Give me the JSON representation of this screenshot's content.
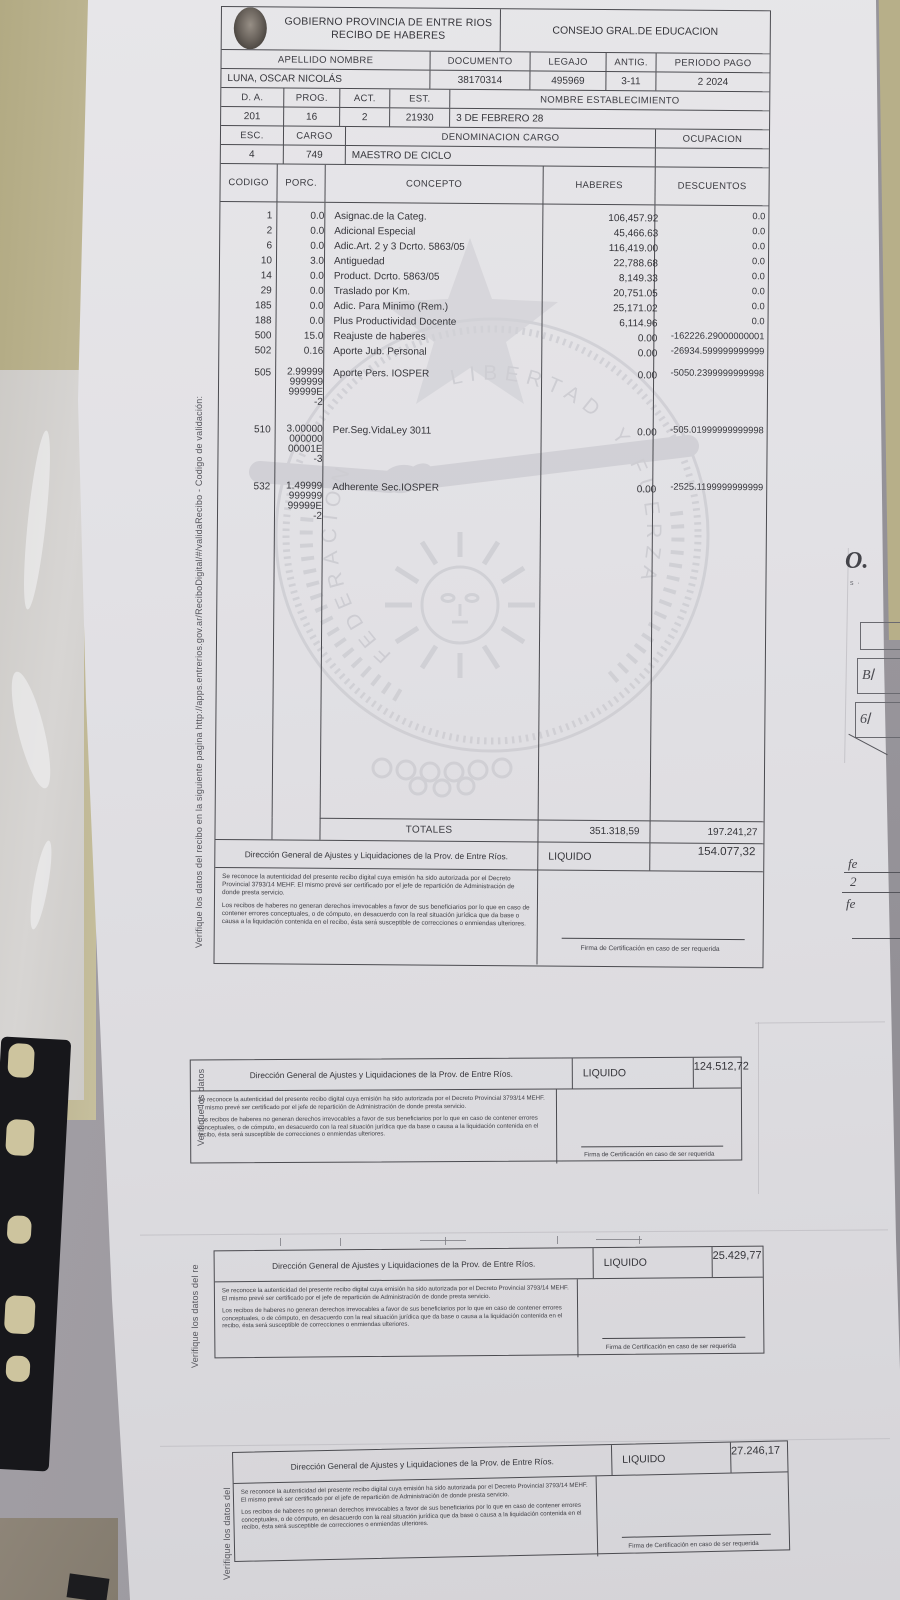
{
  "header": {
    "org_line1": "GOBIERNO PROVINCIA DE ENTRE RIOS",
    "org_line2": "RECIBO DE HABERES",
    "council": "CONSEJO GRAL.DE EDUCACION",
    "logo_name": "provincial-seal"
  },
  "employee": {
    "labels": {
      "name": "APELLIDO NOMBRE",
      "document": "DOCUMENTO",
      "file": "LEGAJO",
      "seniority": "ANTIG.",
      "pay_period": "PERIODO PAGO"
    },
    "values": {
      "name": "LUNA, OSCAR NICOLÁS",
      "document": "38170314",
      "file": "495969",
      "seniority": "3-11",
      "pay_period": "2 2024"
    }
  },
  "assignment": {
    "labels1": {
      "da": "D. A.",
      "prog": "PROG.",
      "act": "ACT.",
      "est": "EST.",
      "establishment": "NOMBRE ESTABLECIMIENTO"
    },
    "values1": {
      "da": "201",
      "prog": "16",
      "act": "2",
      "est": "21930",
      "establishment": "3 DE FEBRERO 28"
    },
    "labels2": {
      "esc": "ESC.",
      "cargo": "CARGO",
      "denominacion": "DENOMINACION CARGO",
      "ocupacion": "OCUPACION"
    },
    "values2": {
      "esc": "4",
      "cargo": "749",
      "denominacion": "MAESTRO DE CICLO",
      "ocupacion": ""
    }
  },
  "table": {
    "headers": {
      "code": "CODIGO",
      "porc": "PORC.",
      "concept": "CONCEPTO",
      "haberes": "HABERES",
      "descuentos": "DESCUENTOS"
    },
    "rows": [
      {
        "code": "1",
        "porc": "0.0",
        "concept": "Asignac.de la Categ.",
        "haberes": "106,457.92",
        "descuentos": "0.0"
      },
      {
        "code": "2",
        "porc": "0.0",
        "concept": "Adicional Especial",
        "haberes": "45,466.63",
        "descuentos": "0.0"
      },
      {
        "code": "6",
        "porc": "0.0",
        "concept": "Adic.Art. 2 y 3 Dcrto. 5863/05",
        "haberes": "116,419.00",
        "descuentos": "0.0"
      },
      {
        "code": "10",
        "porc": "3.0",
        "concept": "Antiguedad",
        "haberes": "22,788.68",
        "descuentos": "0.0"
      },
      {
        "code": "14",
        "porc": "0.0",
        "concept": "Product. Dcrto. 5863/05",
        "haberes": "8,149.33",
        "descuentos": "0.0"
      },
      {
        "code": "29",
        "porc": "0.0",
        "concept": "Traslado por Km.",
        "haberes": "20,751.05",
        "descuentos": "0.0"
      },
      {
        "code": "185",
        "porc": "0.0",
        "concept": "Adic. Para Minimo (Rem.)",
        "haberes": "25,171.02",
        "descuentos": "0.0"
      },
      {
        "code": "188",
        "porc": "0.0",
        "concept": "Plus Productividad Docente",
        "haberes": "6,114.96",
        "descuentos": "0.0"
      },
      {
        "code": "500",
        "porc": "15.0",
        "concept": "Reajuste de haberes",
        "haberes": "0.00",
        "descuentos": "-162226.29000000001"
      },
      {
        "code": "502",
        "porc": "0.16",
        "concept": "Aporte Jub. Personal",
        "haberes": "0.00",
        "descuentos": "-26934.599999999999"
      },
      {
        "code": "505",
        "porc": "2.99999 999999 99999E -2",
        "concept": "Aporte Pers. IOSPER",
        "haberes": "0.00",
        "descuentos": "-5050.2399999999998"
      },
      {
        "code": "510",
        "porc": "3.00000 000000 00001E -3",
        "concept": "Per.Seg.VidaLey 3011",
        "haberes": "0.00",
        "descuentos": "-505.01999999999998"
      },
      {
        "code": "532",
        "porc": "1.49999 999999 99999E -2",
        "concept": "Adherente Sec.IOSPER",
        "haberes": "0.00",
        "descuentos": "-2525.1199999999999"
      }
    ],
    "totals": {
      "label": "TOTALES",
      "haberes": "351.318,59",
      "descuentos": "197.241,27"
    }
  },
  "footer": {
    "direccion": "Dirección General de Ajustes y Liquidaciones de la Prov. de Entre Ríos.",
    "liquido_label": "LIQUIDO",
    "legal_p1": "Se reconoce la autenticidad del presente recibo digital cuya emisión ha sido autorizada por el Decreto Provincial 3793/14 MEHF. El mismo prevé ser certificado por el jefe de repartición de Administración de donde presta servicio.",
    "legal_p2": "Los recibos de haberes no generan derechos irrevocables a favor de sus beneficiarios por lo que en caso de contener errores conceptuales, o de cómputo, en desacuerdo con la real situación jurídica que da base o causa a la liquidación contenida en el recibo, ésta será susceptible de correcciones o enmiendas ulteriores.",
    "firma": "Firma de Certificación en caso de ser requerida"
  },
  "receipts": [
    {
      "liquido": "154.077,32"
    },
    {
      "liquido": "124.512,72"
    },
    {
      "liquido": "25.429,77"
    },
    {
      "liquido": "27.246,17"
    }
  ],
  "validation": {
    "full": "Verifique los datos del recibo en la siguiente pagina http://apps.entrerios.gov.ar/ReciboDigital/#/validaRecibo  -  Codigo de validación:",
    "partial1": "Verifique los datos",
    "partial2": "Verifique los datos del re",
    "partial3": "Verifique los datos del"
  },
  "watermark": {
    "arc_left": "FEDERACION",
    "arc_top": "LIBERTAD",
    "arc_right": "Y FUERZA"
  },
  "fragments": {
    "o": "O.",
    "b": "B",
    "six": "6",
    "fe_top": "fe",
    "two": "2",
    "fe_bottom": "fe"
  }
}
